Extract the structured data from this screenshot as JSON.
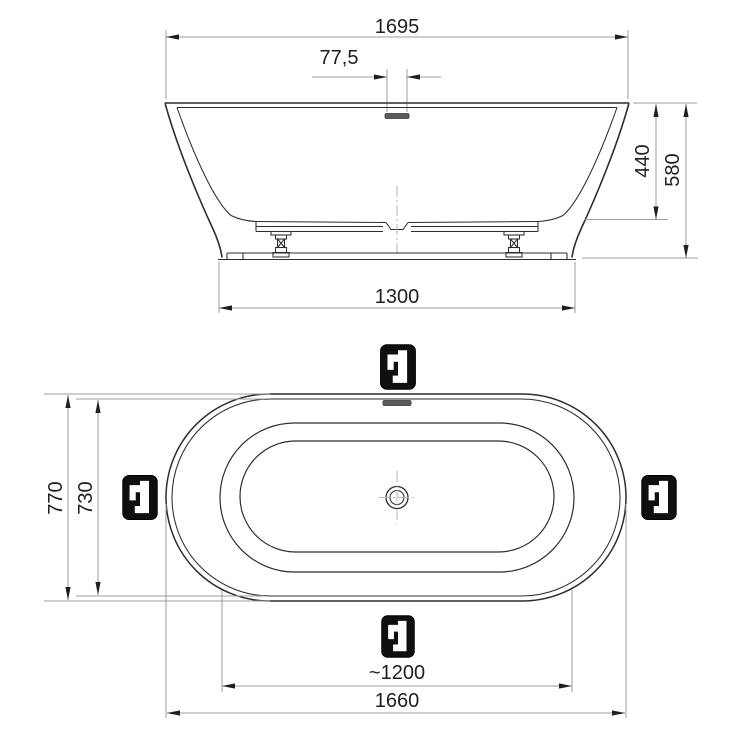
{
  "document": {
    "type": "technical dimension drawing",
    "subject": "freestanding oval bathtub - side elevation and plan view",
    "views": {
      "side_elevation": {
        "name": "side elevation",
        "dimensions": {
          "overall_length": "1695",
          "overflow_offset": "77,5",
          "shell_depth": "440",
          "overall_height": "580",
          "base_length": "1300"
        },
        "features": [
          "overflow-slot",
          "support-frame",
          "adjustable-feet",
          "base-plinth"
        ]
      },
      "plan": {
        "name": "plan view (top)",
        "dimensions": {
          "overall_width": "770",
          "inner_width": "730",
          "basin_length": "~1200",
          "overall_length": "1660"
        },
        "features": [
          "rim-double-outline",
          "inner-rim",
          "basin",
          "drain-with-crosshair",
          "overflow-slot"
        ],
        "markers": {
          "icon": "standing-faucet-position-icon",
          "count": 4,
          "positions": [
            "top",
            "left",
            "right",
            "bottom"
          ]
        }
      }
    },
    "colors": {
      "background": "#ffffff",
      "outline": "#2d2d2d",
      "dimension_line": "#9c9c9c",
      "text": "#1f1f1f",
      "marker_background": "#0f0f0f",
      "marker_glyph": "#ffffff",
      "overflow_slot": "#5c5c5c"
    }
  }
}
